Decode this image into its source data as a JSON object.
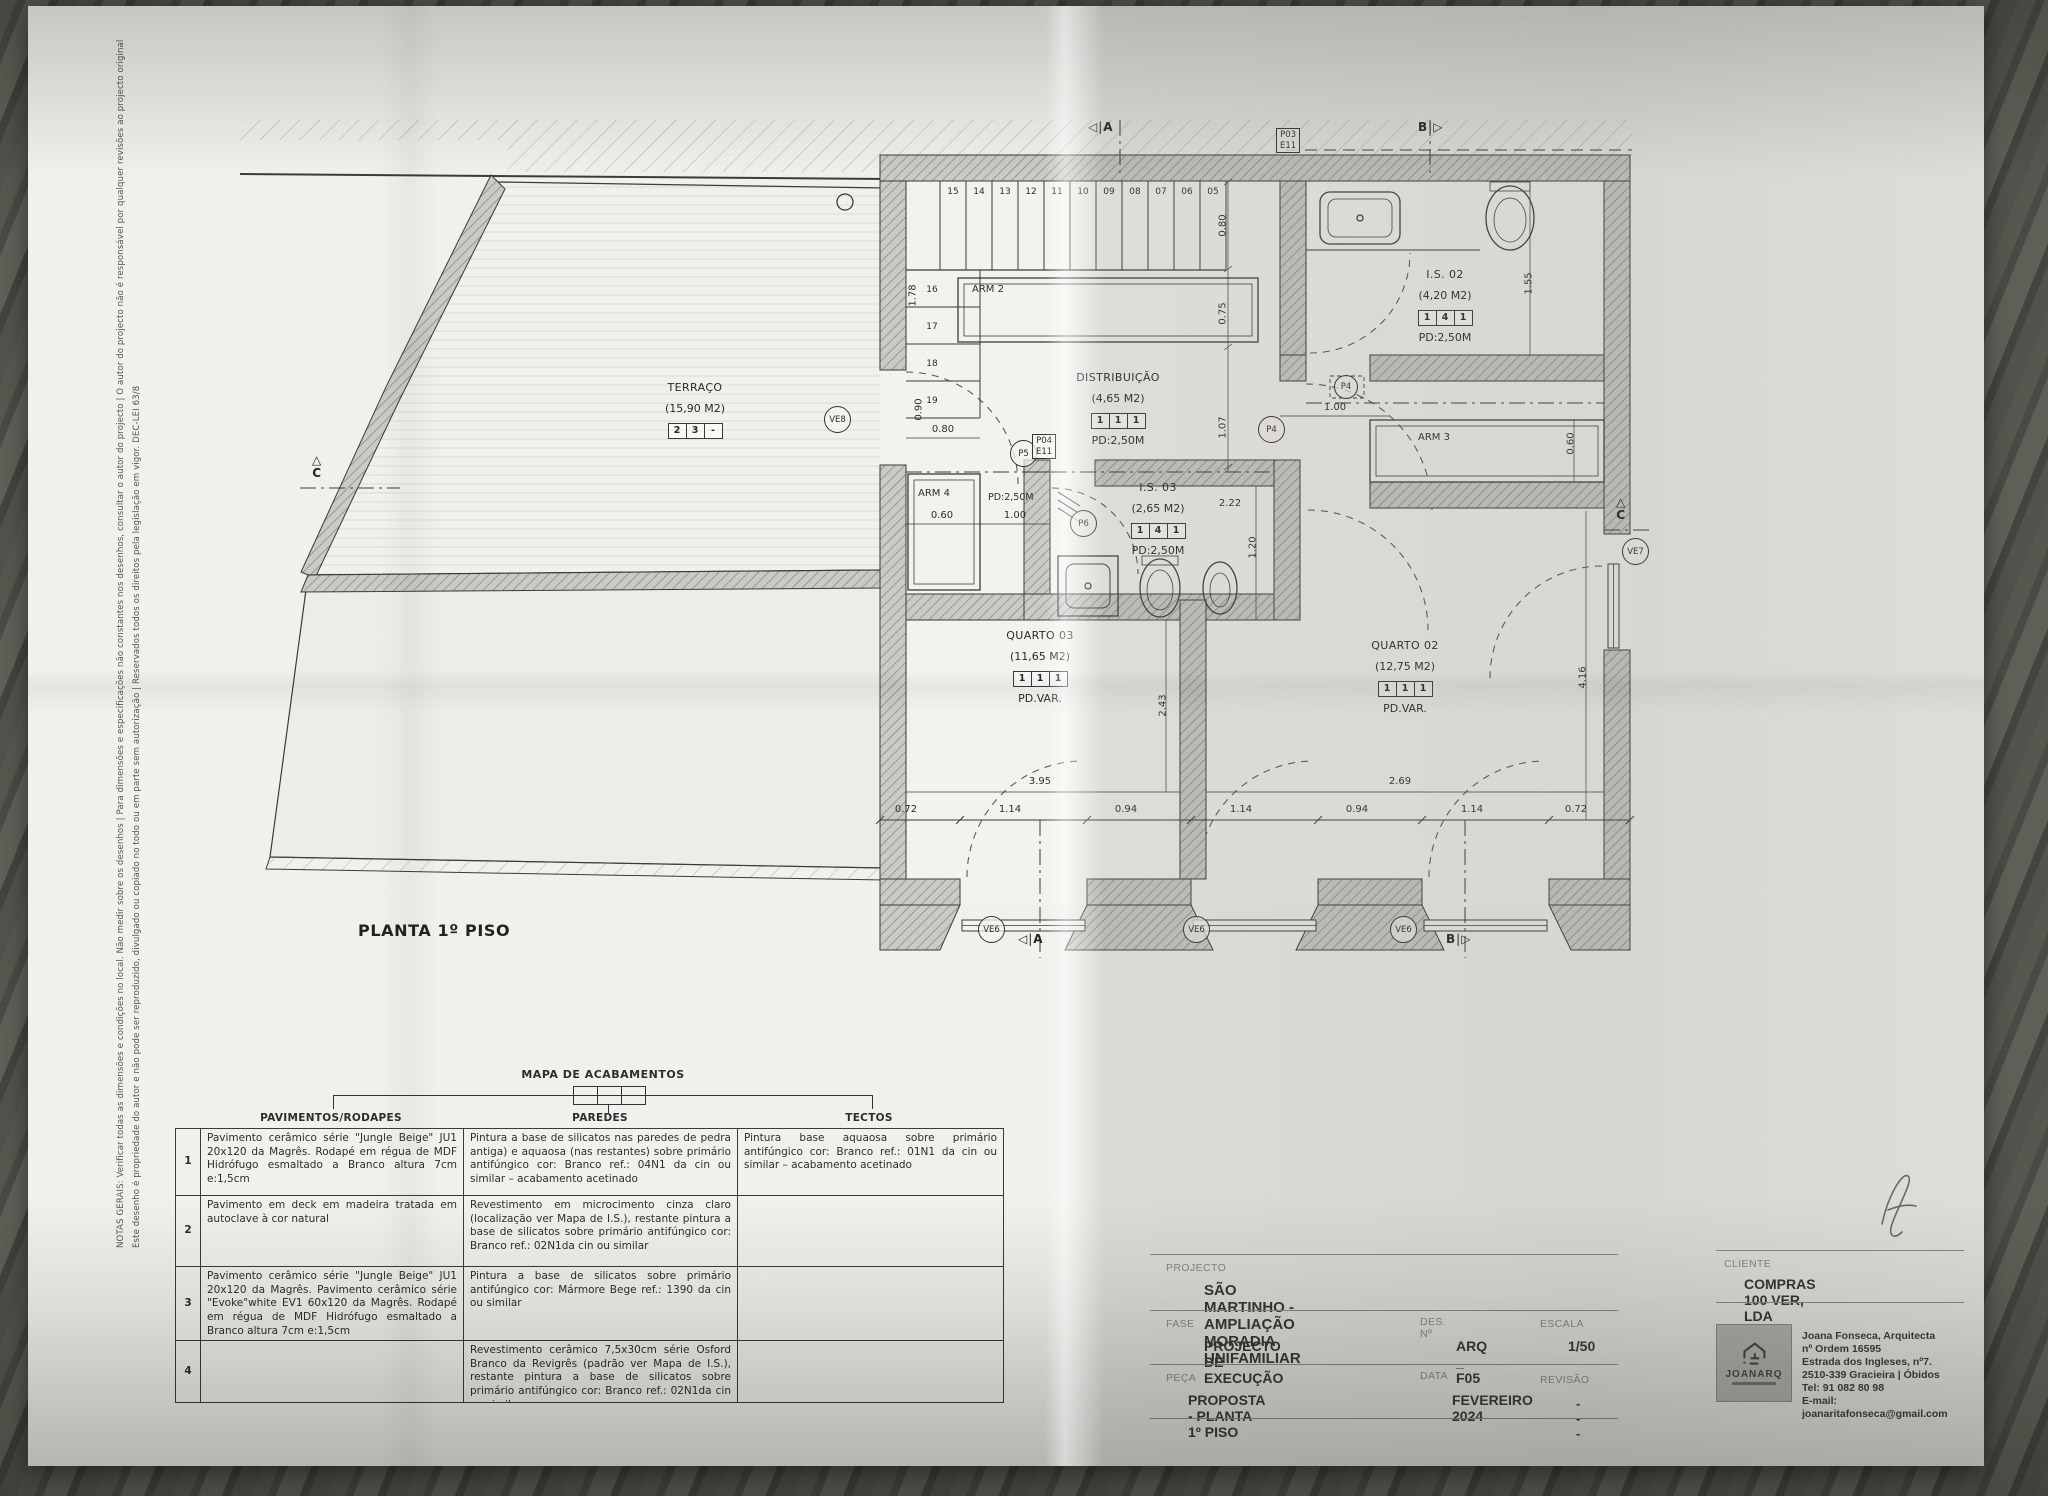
{
  "plan": {
    "title": "PLANTA 1º PISO",
    "rooms": {
      "terraco": {
        "name": "TERRAÇO",
        "area": "(15,90 M2)",
        "f": [
          "2",
          "3",
          "-"
        ]
      },
      "distribuicao": {
        "name": "DISTRIBUIÇÃO",
        "area": "(4,65 M2)",
        "f": [
          "1",
          "1",
          "1"
        ],
        "pd": "PD:2,50M"
      },
      "is02": {
        "name": "I.S. 02",
        "area": "(4,20 M2)",
        "f": [
          "1",
          "4",
          "1"
        ],
        "pd": "PD:2,50M"
      },
      "is03": {
        "name": "I.S. 03",
        "area": "(2,65 M2)",
        "f": [
          "1",
          "4",
          "1"
        ],
        "pd": "PD:2,50M"
      },
      "quarto03": {
        "name": "QUARTO 03",
        "area": "(11,65 M2)",
        "f": [
          "1",
          "1",
          "1"
        ],
        "pd": "PD.VAR."
      },
      "quarto02": {
        "name": "QUARTO 02",
        "area": "(12,75 M2)",
        "f": [
          "1",
          "1",
          "1"
        ],
        "pd": "PD.VAR."
      },
      "arm2": {
        "name": "ARM 2"
      },
      "arm3": {
        "name": "ARM 3"
      },
      "arm4": {
        "name": "ARM 4"
      }
    },
    "stairs_top": [
      "15",
      "14",
      "13",
      "12",
      "11",
      "10",
      "09",
      "08",
      "07",
      "06",
      "05"
    ],
    "stairs_left": [
      "16",
      "17",
      "18",
      "19"
    ],
    "dims": {
      "v178": "1.78",
      "h080l": "0.80",
      "v090": "0.90",
      "v080r": "0.80",
      "v075": "0.75",
      "v107": "1.07",
      "h100p4": "1.00",
      "v155": "1.55",
      "v060arm3": "0.60",
      "h222": "2.22",
      "v120": "1.20",
      "h060arm4": "0.60",
      "h100arm4": "1.00",
      "pd_hall": "PD:2,50M",
      "v243": "2.43",
      "v416": "4.16",
      "h395": "3.95",
      "h269": "2.69",
      "row": [
        "0.72",
        "1.14",
        "0.94",
        "1.14",
        "0.94",
        "1.14",
        "0.72"
      ]
    },
    "tags": {
      "ve8": "VE8",
      "ve6": "VE6",
      "ve7": "VE7",
      "p4": "P4",
      "p5": "P5",
      "p6": "P6",
      "p04": "P04",
      "e11": "E11",
      "p03": "P03",
      "a": "A",
      "b": "B",
      "c": "C",
      "tri_l": "◁",
      "tri_r": "▷",
      "tri_u": "△",
      "bar": "|"
    }
  },
  "margin_notes": {
    "line1": "NOTAS GERAIS: Verificar todas as dimensões e condições no local. Não medir sobre os desenhos | Para dimensões e especificações não constantes nos desenhos, consultar o autor do projecto | O autor do projecto não é responsável por qualquer revisões ao projecto original",
    "line2": "Este desenho é propriedade do autor e não pode ser reproduzido, divulgado ou copiado no todo ou em parte sem autorização | Reservados todos os direitos pela legislação em vigor. DEC-LEI 63/8"
  },
  "finishes_map": {
    "title": "MAPA DE ACABAMENTOS",
    "columns": [
      "PAVIMENTOS/RODAPES",
      "PAREDES",
      "TECTOS"
    ],
    "rows": [
      {
        "num": "1",
        "pavimentos": "Pavimento cerâmico série \"Jungle Beige\" JU1 20x120 da Magrês. Rodapé em régua de MDF Hidrófugo esmaltado a Branco altura 7cm e:1,5cm",
        "paredes": "Pintura a base de silicatos nas paredes de pedra antiga) e aquaosa (nas restantes) sobre primário antifúngico cor: Branco ref.: 04N1 da cin ou similar – acabamento acetinado",
        "tectos": "Pintura base aquaosa sobre primário antifúngico cor: Branco ref.: 01N1 da cin ou similar – acabamento acetinado"
      },
      {
        "num": "2",
        "pavimentos": "Pavimento em deck em madeira tratada em autoclave à cor natural",
        "paredes": "Revestimento em microcimento cinza claro (localização ver Mapa de I.S.), restante pintura a base de silicatos sobre primário antifúngico cor: Branco ref.: 02N1da cin ou similar",
        "tectos": ""
      },
      {
        "num": "3",
        "pavimentos": "Pavimento cerâmico série \"Jungle Beige\" JU1 20x120 da Magrês. Pavimento cerâmico série \"Evoke\"white EV1 60x120 da Magrês. Rodapé em régua de MDF Hidrófugo esmaltado a Branco altura 7cm e:1,5cm",
        "paredes": "Pintura a base de silicatos sobre primário antifúngico cor: Mármore Bege ref.: 1390 da cin ou similar",
        "tectos": ""
      },
      {
        "num": "4",
        "pavimentos": "",
        "paredes": "Revestimento cerâmico 7,5x30cm série Osford Branco da Revigrês (padrão ver Mapa de I.S.), restante pintura a base de silicatos sobre primário antifúngico cor: Branco ref.: 02N1da cin ou similar",
        "tectos": ""
      }
    ]
  },
  "titleblock": {
    "projecto_label": "PROJECTO",
    "projecto": "SÃO MARTINHO  -  AMPLIAÇÃO  MORADIA UNIFAMILIAR",
    "fase_label": "FASE",
    "fase": "PROJECTO DE EXECUÇÃO",
    "des_label": "DES. Nº",
    "des": "ARQ _ F05",
    "escala_label": "ESCALA",
    "escala": "1/50",
    "peca_label": "PEÇA",
    "peca": "PROPOSTA - PLANTA 1º PISO",
    "data_label": "DATA",
    "data": "FEVEREIRO 2024",
    "revisao_label": "REVISÃO",
    "revisao": "- - -",
    "cliente_label": "CLIENTE",
    "cliente": "COMPRAS 100 VER, LDA",
    "logo": "JOANARQ",
    "contact": [
      "Joana Fonseca, Arquitecta nº Ordem 16595",
      "Estrada dos Ingleses, nº7.",
      "2510-339 Gracieira | Óbidos",
      "Tel: 91 082 80 98",
      "E-mail: joanaritafonseca@gmail.com"
    ]
  }
}
